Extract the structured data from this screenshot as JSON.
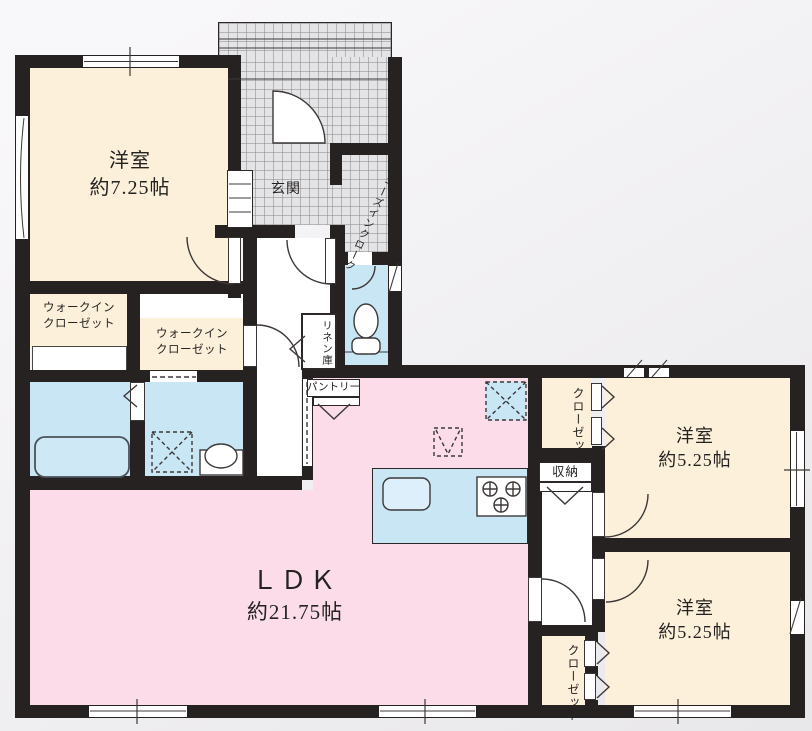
{
  "title": "3LDK floor plan",
  "colors": {
    "wall": "#272222",
    "room_cream": "#fcf0da",
    "ldk_pink": "#fbdce8",
    "wet_blue": "#c9e6f4",
    "entrance_tile": "#e4e3e5",
    "background": "#efeef0",
    "line": "#3c3838"
  },
  "labels": {
    "bedroom1_name": "洋室",
    "bedroom1_size": "約7.25帖",
    "entrance": "玄関",
    "sic": "シューズインクローク",
    "wic1_l1": "ウォークイン",
    "wic1_l2": "クローゼット",
    "wic2_l1": "ウォークイン",
    "wic2_l2": "クローゼット",
    "linen": "リネン庫",
    "pantry": "パントリー",
    "ldk_name": "ＬＤＫ",
    "ldk_size": "約21.75帖",
    "closet_top": "クローゼット",
    "storage": "収納",
    "bedroom2_name": "洋室",
    "bedroom2_size": "約5.25帖",
    "bedroom3_name": "洋室",
    "bedroom3_size": "約5.25帖",
    "closet_bottom": "クローゼット"
  },
  "fixtures": [
    "entrance-door",
    "shoe-cabinet",
    "bathtub",
    "washing-machine-space",
    "wash-basin",
    "toilet",
    "kitchen-island",
    "kitchen-sink",
    "gas-stove",
    "refrigerator-space",
    "windows",
    "folding-doors",
    "swing-doors"
  ]
}
